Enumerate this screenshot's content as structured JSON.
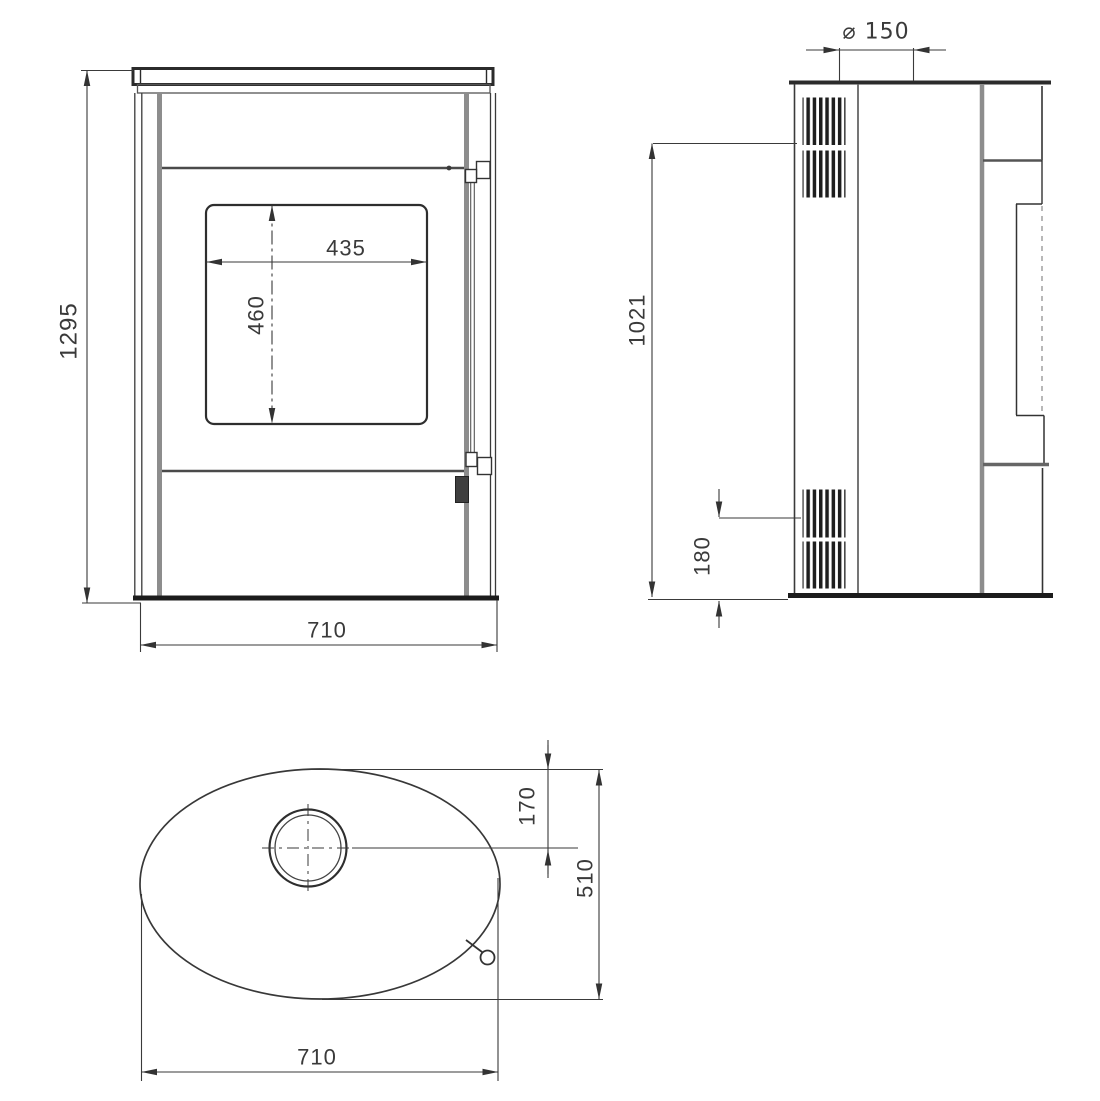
{
  "drawing_type": "stove dimensional drawing, three orthographic views",
  "views": {
    "front": {
      "overall_height": "1295",
      "glass_width": "435",
      "glass_height": "460",
      "overall_width": "710"
    },
    "side": {
      "flue_diameter": "⌀ 150",
      "upper_vent_height": "1021",
      "lower_vent_height": "180"
    },
    "top": {
      "flue_center_offset": "170",
      "depth": "510",
      "width": "710"
    }
  },
  "colors": {
    "background": "#ffffff",
    "line": "#3a3a3a",
    "dark_line": "#1f1f1f",
    "panel_gray": "#8d8d8d"
  }
}
